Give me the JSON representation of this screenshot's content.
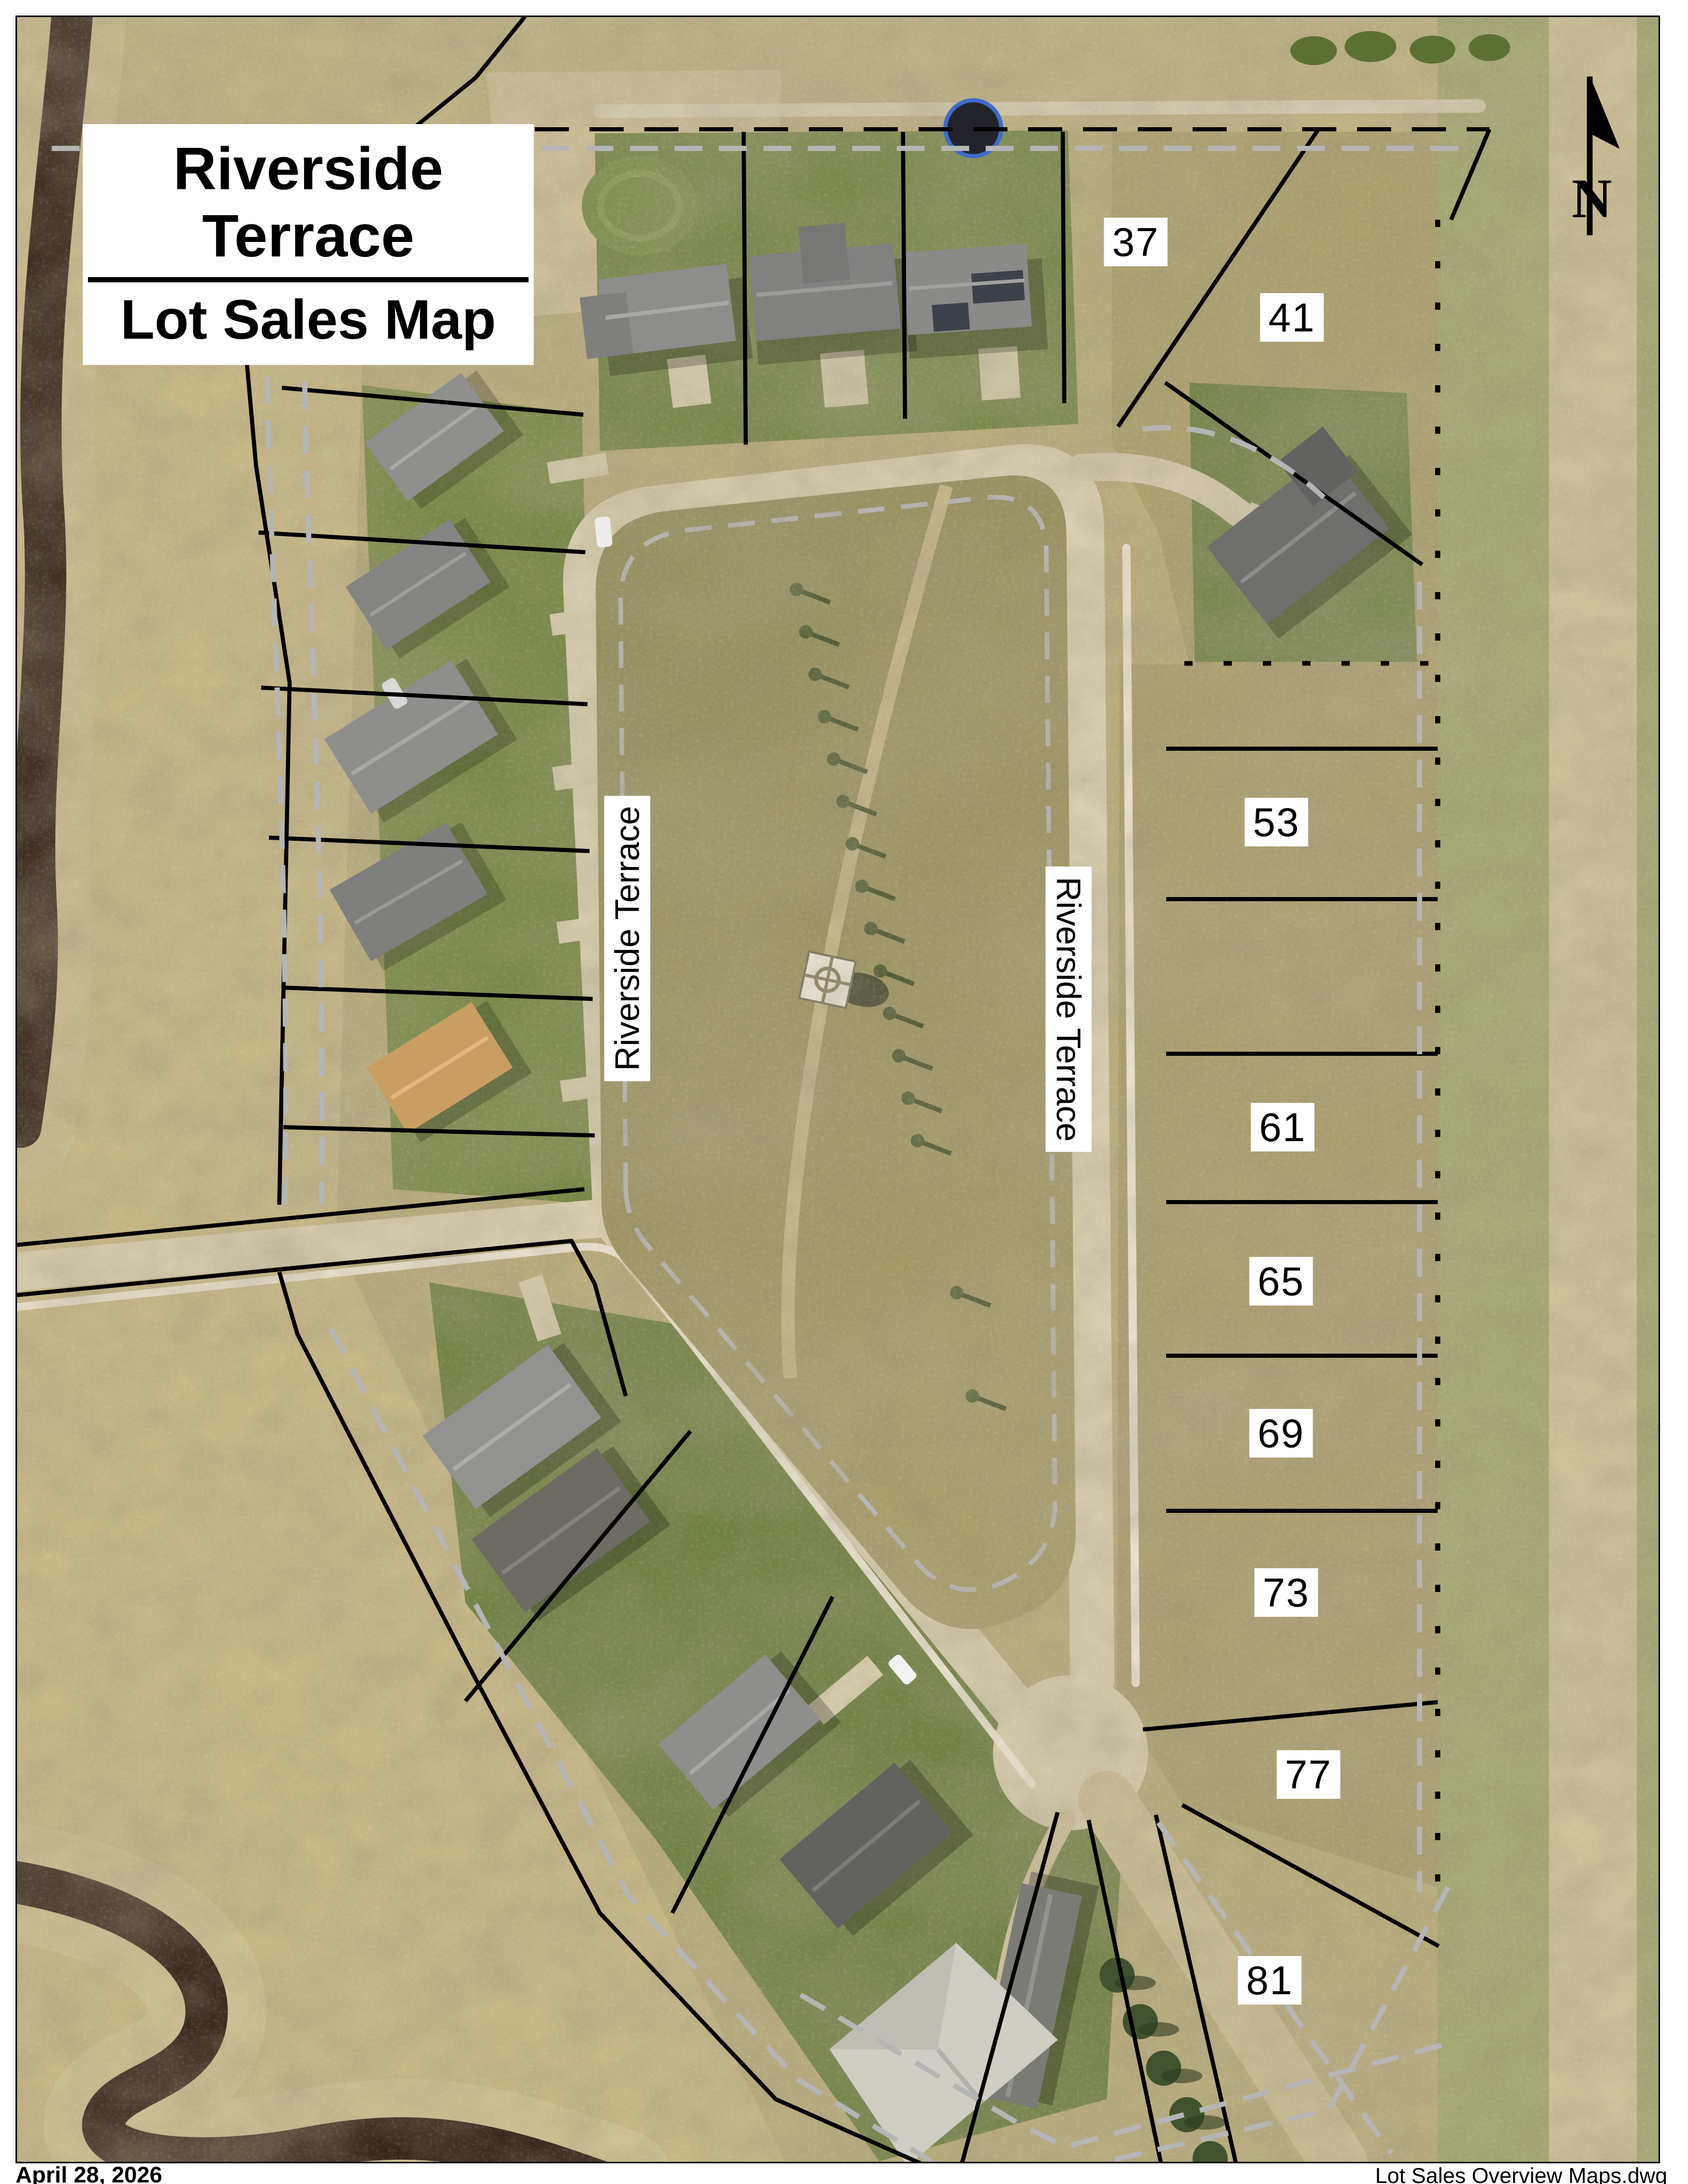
{
  "title_block": {
    "line1": "Riverside Terrace",
    "line2": "Lot Sales Map"
  },
  "north": {
    "label": "N"
  },
  "streets": {
    "west_leg": "Riverside Terrace",
    "east_leg": "Riverside Terrace"
  },
  "lots": [
    {
      "number": "37"
    },
    {
      "number": "41"
    },
    {
      "number": "53"
    },
    {
      "number": "61"
    },
    {
      "number": "65"
    },
    {
      "number": "69"
    },
    {
      "number": "73"
    },
    {
      "number": "77"
    },
    {
      "number": "81"
    }
  ],
  "footer": {
    "date": "April 28, 2026",
    "filename": "Lot Sales Overview Maps.dwg"
  },
  "colors": {
    "lot_line": "#000000",
    "easement_line": "#b5b5b5",
    "label_bg": "#ffffff",
    "label_text": "#000000",
    "road": "#d8cfb1",
    "grass_green": "#6f7f45",
    "ground_tan": "#b9ac7e",
    "river": "#33241a"
  }
}
